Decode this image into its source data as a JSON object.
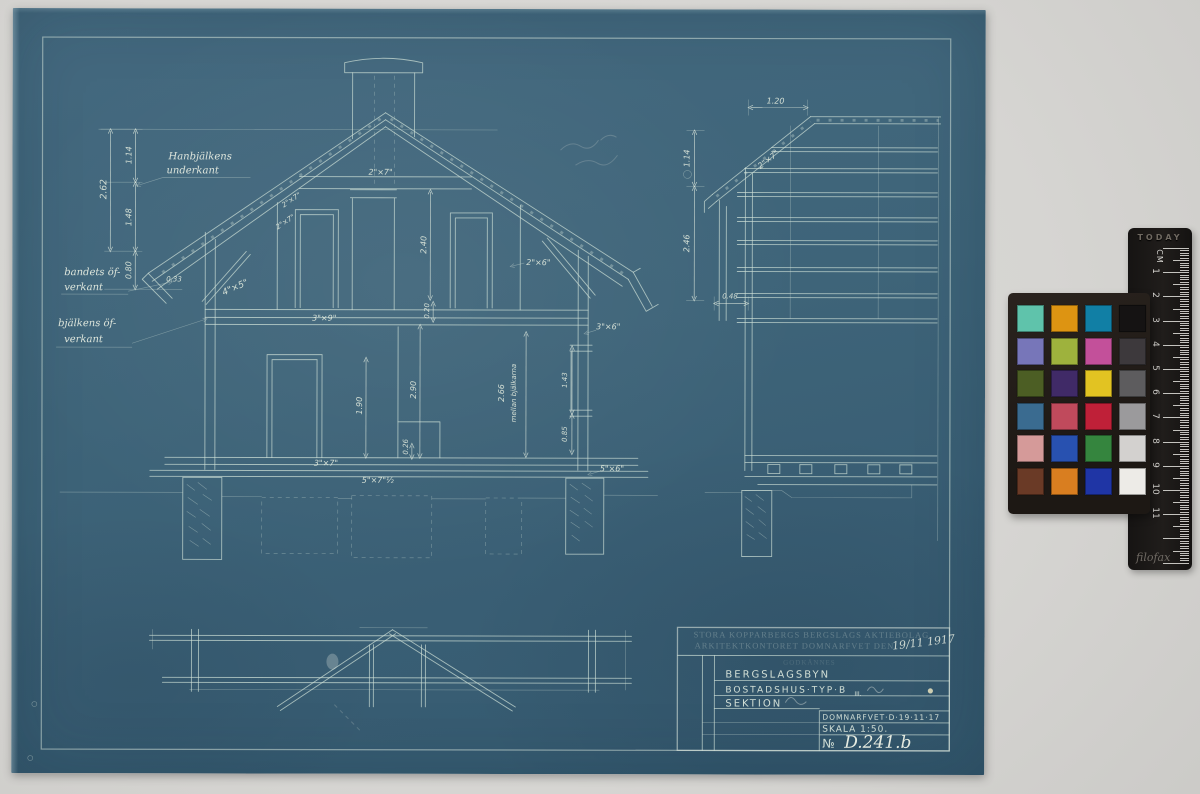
{
  "blueprint": {
    "stamp": {
      "line1": "STORA KOPPARBERGS BERGSLAGS AKTIEBOLAG",
      "line2": "ARKITEKTKONTORET DOMNARFVET DEN",
      "date": "19/11 1917",
      "approval": "GODKÄNNES"
    },
    "title_block": {
      "project": "BERGSLAGSBYN",
      "building": "BOSTADSHUS·TYP·B",
      "building_sub": "III.",
      "drawing": "SEKTION",
      "place_date": "DOMNARFVET·D·19·11·17",
      "scale": "SKALA 1:50.",
      "no_sign": "№",
      "number": "D.241.b"
    },
    "labels": {
      "han1": "Hanbjälkens",
      "han2": "underkant",
      "band1": "bandets öf-",
      "band2": "verkant",
      "bjalk1": "bjälkens öf-",
      "bjalk2": "verkant"
    },
    "dims": {
      "v262": "2.62",
      "v114": "1.14",
      "v148": "1.48",
      "v080": "0.80",
      "v033": "0.33",
      "s45": "4\"×5\"",
      "s27c": "2\"×7\"",
      "s27a": "2\"×7\"",
      "s27b": "2\"×7\"",
      "v240": "2.40",
      "s26": "2\"×6\"",
      "s36": "3\"×6\"",
      "s39": "3\"×9\"",
      "v290": "2.90",
      "v190": "1.90",
      "v020": "0.20",
      "v026": "0.26",
      "v266": "2.66",
      "mellan": "mellan bjälkarna",
      "v143": "1.43",
      "v085": "0.85",
      "s37": "3\"×7\"",
      "s57": "5\"×7\"½",
      "s56": "5\"×6\"",
      "r120": "1.20",
      "r114": "1.14",
      "r246": "2.46",
      "r048": "0.48",
      "rs27": "2\"×7\""
    }
  },
  "color_chart": {
    "rows": [
      [
        "#5fc3ab",
        "#dd9412",
        "#117fa5",
        "#151313"
      ],
      [
        "#7776b9",
        "#9eb23d",
        "#c3509a",
        "#3d393c"
      ],
      [
        "#4c5e24",
        "#402a67",
        "#e2c322",
        "#5d5c5e"
      ],
      [
        "#3a6b90",
        "#c04a5c",
        "#bf2038",
        "#9b9a9c"
      ],
      [
        "#d59a99",
        "#2851b0",
        "#35853e",
        "#d3d1cf"
      ],
      [
        "#6a3a26",
        "#d97e20",
        "#1f35a5",
        "#edebe7"
      ]
    ]
  },
  "ruler": {
    "brand": "TODAY",
    "unit": "CM",
    "numbers": [
      "1",
      "2",
      "3",
      "4",
      "5",
      "6",
      "7",
      "8",
      "9",
      "10",
      "11"
    ],
    "brand_script": "filofax"
  }
}
